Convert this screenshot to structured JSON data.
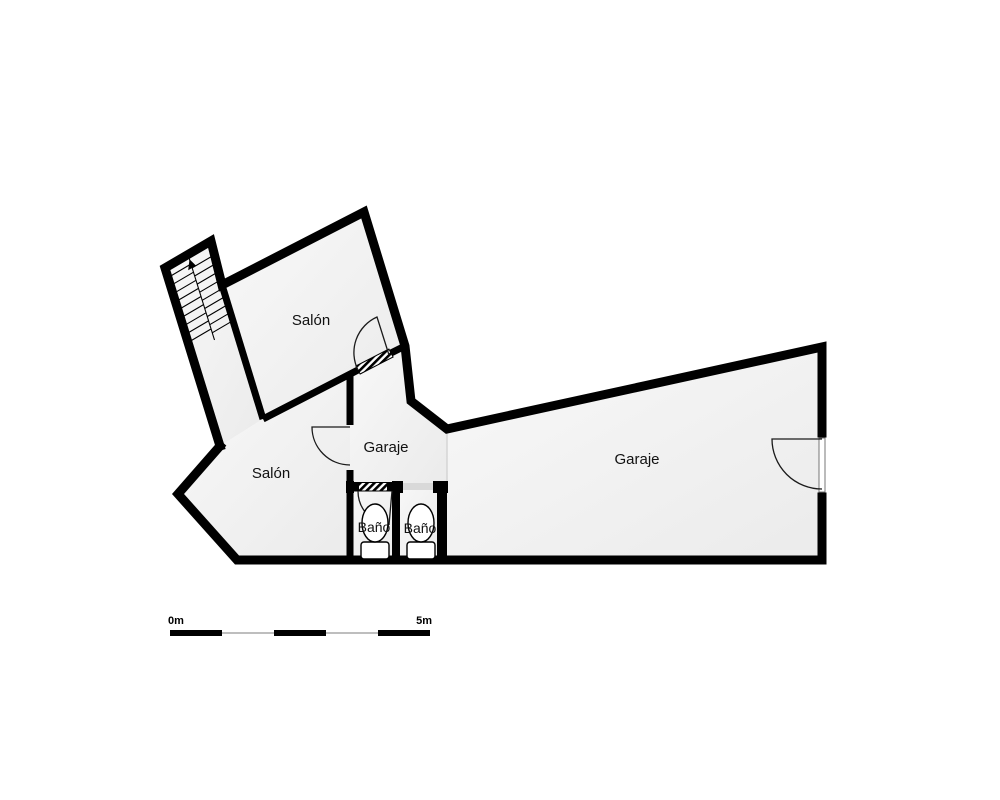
{
  "floor_plan": {
    "rooms": [
      {
        "id": "salon-upper",
        "label": "Salón"
      },
      {
        "id": "salon-lower",
        "label": "Salón"
      },
      {
        "id": "garaje-small",
        "label": "Garaje"
      },
      {
        "id": "garaje-large",
        "label": "Garaje"
      },
      {
        "id": "bano-left",
        "label": "Baño"
      },
      {
        "id": "bano-right",
        "label": "Baño"
      }
    ],
    "features": [
      "staircase",
      "toilet",
      "door-arc",
      "door-sill"
    ],
    "scale_bar": {
      "start_label": "0m",
      "end_label": "5m"
    },
    "colors": {
      "wall": "#000000",
      "floor": "#f0f0f0",
      "background": "#ffffff",
      "opening_fill": "#d9d9d9",
      "door_line": "#1a1a1a",
      "scale_thin_line": "#a8a8a8",
      "label_text": "#111111"
    }
  }
}
